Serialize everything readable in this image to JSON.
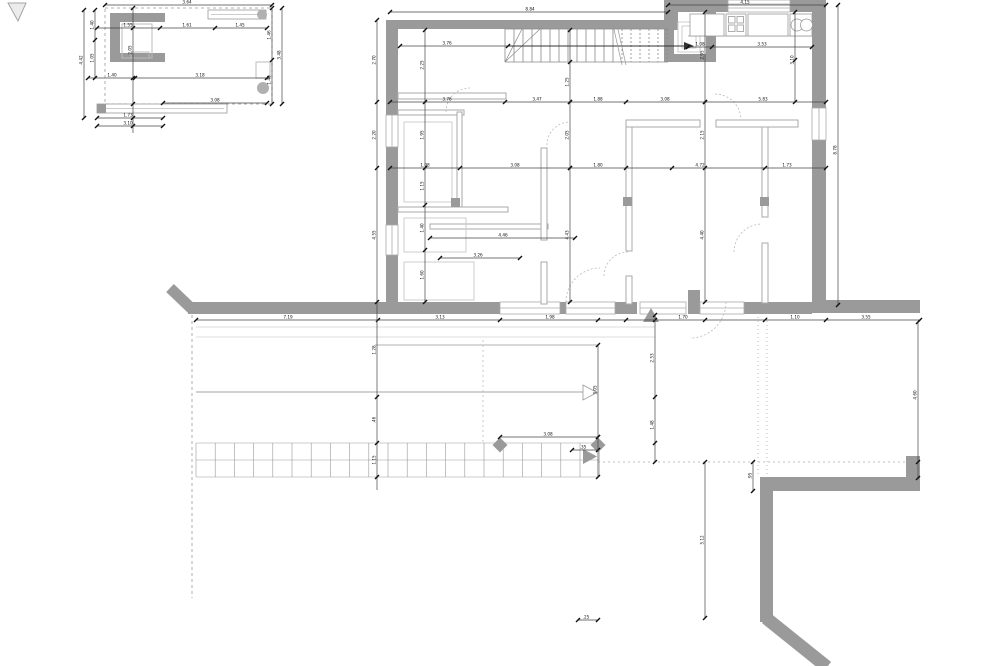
{
  "drawing_type": "architectural-floor-plan",
  "colors": {
    "wall": "#9a9a9a",
    "partition": "#aaaaaa",
    "fixture": "#c8c8c8",
    "dim_line": "#444444",
    "tick": "#111111",
    "text": "#111111",
    "light_line": "#d0d0d0",
    "dash": "#999999",
    "arrow": "#9a9a9a",
    "stair_line": "#888888",
    "tile_line": "#999999"
  },
  "tile_grid": {
    "x": 196,
    "y": 443,
    "cols": 21,
    "col_w": 19.2,
    "rows": 2,
    "row_h": 17
  },
  "stairs": {
    "x_start": 505,
    "x_end": 668,
    "y_top": 29,
    "y_bottom": 62,
    "step": 9,
    "dash_from": 618
  },
  "main": {
    "dim_chains": [
      {
        "dir": "h",
        "pos": 12,
        "from": 390,
        "to": 668,
        "ticks": [
          390,
          668
        ],
        "labels": [
          {
            "at": 530,
            "t": "8.84"
          }
        ]
      },
      {
        "dir": "h",
        "pos": 5,
        "from": 668,
        "to": 826,
        "ticks": [
          668,
          826
        ],
        "labels": [
          {
            "at": 745,
            "t": "4.15"
          }
        ]
      },
      {
        "dir": "h",
        "pos": 46,
        "from": 400,
        "to": 508,
        "ticks": [
          400,
          508
        ],
        "labels": [
          {
            "at": 447,
            "t": "3.76"
          }
        ]
      },
      {
        "dir": "h",
        "pos": 47,
        "from": 688,
        "to": 812,
        "ticks": [
          688,
          712,
          812
        ],
        "labels": [
          {
            "at": 700,
            "t": "1.08"
          },
          {
            "at": 762,
            "t": "3.53"
          }
        ]
      },
      {
        "dir": "h",
        "pos": 102,
        "from": 390,
        "to": 826,
        "ticks": [
          390,
          505,
          570,
          626,
          705,
          826
        ],
        "labels": [
          {
            "at": 447,
            "t": "3.76"
          },
          {
            "at": 537,
            "t": "3.47"
          },
          {
            "at": 598,
            "t": "1.88"
          },
          {
            "at": 665,
            "t": "3.08"
          },
          {
            "at": 763,
            "t": "5.83"
          }
        ]
      },
      {
        "dir": "h",
        "pos": 168,
        "from": 390,
        "to": 826,
        "ticks": [
          390,
          460,
          570,
          626,
          672,
          765,
          826
        ],
        "labels": [
          {
            "at": 425,
            "t": "1.98"
          },
          {
            "at": 515,
            "t": "3.08"
          },
          {
            "at": 598,
            "t": "1.80"
          },
          {
            "at": 700,
            "t": "4.72"
          },
          {
            "at": 787,
            "t": "1.73"
          }
        ]
      },
      {
        "dir": "h",
        "pos": 238,
        "from": 430,
        "to": 575,
        "ticks": [
          430,
          575
        ],
        "labels": [
          {
            "at": 503,
            "t": "4.46"
          }
        ]
      },
      {
        "dir": "h",
        "pos": 258,
        "from": 440,
        "to": 520,
        "ticks": [
          440,
          520
        ],
        "labels": [
          {
            "at": 478,
            "t": "3.26"
          }
        ]
      },
      {
        "dir": "h",
        "pos": 320,
        "from": 196,
        "to": 920,
        "ticks": [
          196,
          378,
          500,
          598,
          626,
          655,
          705,
          765,
          826,
          920
        ],
        "labels": [
          {
            "at": 288,
            "t": "7.19"
          },
          {
            "at": 440,
            "t": "3.13"
          },
          {
            "at": 550,
            "t": "1.98"
          },
          {
            "at": 683,
            "t": "1.70"
          },
          {
            "at": 795,
            "t": "1.10"
          },
          {
            "at": 866,
            "t": "3.55"
          }
        ]
      },
      {
        "dir": "h",
        "pos": 437,
        "from": 500,
        "to": 598,
        "ticks": [
          500,
          598
        ],
        "labels": [
          {
            "at": 548,
            "t": "3.08"
          }
        ]
      },
      {
        "dir": "h",
        "pos": 450,
        "from": 572,
        "to": 598,
        "ticks": [
          572,
          598
        ],
        "labels": [
          {
            "at": 583,
            "t": ".35"
          }
        ]
      },
      {
        "dir": "h",
        "pos": 620,
        "from": 578,
        "to": 598,
        "ticks": [
          578,
          598
        ],
        "labels": [
          {
            "at": 586,
            "t": ".25"
          }
        ]
      },
      {
        "dir": "v",
        "pos": 377,
        "from": 20,
        "to": 490,
        "ticks": [
          20,
          102,
          168,
          302,
          397,
          443,
          477
        ],
        "labels": [
          {
            "at": 60,
            "t": "2.70"
          },
          {
            "at": 135,
            "t": "2.20"
          },
          {
            "at": 235,
            "t": "4.55"
          },
          {
            "at": 350,
            "t": "1.28"
          },
          {
            "at": 420,
            "t": ".46"
          },
          {
            "at": 460,
            "t": "1.15"
          }
        ]
      },
      {
        "dir": "v",
        "pos": 425,
        "from": 30,
        "to": 302,
        "ticks": [
          30,
          102,
          168,
          205,
          250,
          302
        ],
        "labels": [
          {
            "at": 65,
            "t": "2.25"
          },
          {
            "at": 135,
            "t": "1.95"
          },
          {
            "at": 186,
            "t": "1.15"
          },
          {
            "at": 228,
            "t": "1.40"
          },
          {
            "at": 275,
            "t": "1.60"
          }
        ]
      },
      {
        "dir": "v",
        "pos": 570,
        "from": 30,
        "to": 302,
        "ticks": [
          30,
          62,
          102,
          168,
          302
        ],
        "labels": [
          {
            "at": 82,
            "t": "1.25"
          },
          {
            "at": 135,
            "t": "2.05"
          },
          {
            "at": 235,
            "t": "4.43"
          }
        ]
      },
      {
        "dir": "v",
        "pos": 705,
        "from": 12,
        "to": 302,
        "ticks": [
          12,
          102,
          168,
          302
        ],
        "labels": [
          {
            "at": 55,
            "t": "2.95"
          },
          {
            "at": 135,
            "t": "2.15"
          },
          {
            "at": 235,
            "t": "4.40"
          }
        ]
      },
      {
        "dir": "v",
        "pos": 795,
        "from": 12,
        "to": 102,
        "ticks": [
          12,
          60,
          102
        ],
        "labels": [
          {
            "at": 60,
            "t": "3.10"
          }
        ]
      },
      {
        "dir": "v",
        "pos": 655,
        "from": 315,
        "to": 462,
        "ticks": [
          315,
          397,
          443,
          462
        ],
        "labels": [
          {
            "at": 358,
            "t": "2.53"
          },
          {
            "at": 425,
            "t": "1.48"
          }
        ]
      },
      {
        "dir": "v",
        "pos": 598,
        "from": 345,
        "to": 477,
        "ticks": [
          345,
          437,
          477
        ],
        "labels": [
          {
            "at": 390,
            "t": "3.05"
          }
        ]
      },
      {
        "dir": "v",
        "pos": 705,
        "from": 462,
        "to": 618,
        "ticks": [
          462,
          618
        ],
        "labels": [
          {
            "at": 540,
            "t": "5.12"
          }
        ]
      },
      {
        "dir": "v",
        "pos": 838,
        "from": 5,
        "to": 305,
        "ticks": [
          5,
          305
        ],
        "labels": [
          {
            "at": 150,
            "t": "8.78"
          }
        ]
      },
      {
        "dir": "v",
        "pos": 918,
        "from": 322,
        "to": 478,
        "ticks": [
          322,
          462,
          478
        ],
        "labels": [
          {
            "at": 395,
            "t": "4.60"
          }
        ]
      },
      {
        "dir": "v",
        "pos": 753,
        "from": 462,
        "to": 491,
        "ticks": [
          462,
          491
        ],
        "labels": [
          {
            "at": 476,
            "t": ".95"
          }
        ]
      }
    ]
  },
  "inset": {
    "dim_chains": [
      {
        "dir": "h",
        "pos": 5,
        "from": 105,
        "to": 272,
        "ticks": [
          105,
          272
        ],
        "labels": [
          {
            "at": 187,
            "t": "3.64"
          }
        ]
      },
      {
        "dir": "h",
        "pos": 28,
        "from": 97,
        "to": 267,
        "ticks": [
          97,
          160,
          215,
          267
        ],
        "labels": [
          {
            "at": 128,
            "t": "1.55"
          },
          {
            "at": 187,
            "t": "1.61"
          },
          {
            "at": 240,
            "t": "1.45"
          }
        ]
      },
      {
        "dir": "h",
        "pos": 78,
        "from": 88,
        "to": 267,
        "ticks": [
          88,
          135,
          267
        ],
        "labels": [
          {
            "at": 112,
            "t": "1.40"
          },
          {
            "at": 200,
            "t": "3.18"
          }
        ]
      },
      {
        "dir": "h",
        "pos": 103,
        "from": 163,
        "to": 267,
        "ticks": [
          163,
          267
        ],
        "labels": [
          {
            "at": 215,
            "t": "3.08"
          }
        ]
      },
      {
        "dir": "h",
        "pos": 118,
        "from": 97,
        "to": 163,
        "ticks": [
          97,
          163
        ],
        "labels": [
          {
            "at": 128,
            "t": "1.73"
          }
        ]
      },
      {
        "dir": "h",
        "pos": 126,
        "from": 97,
        "to": 163,
        "ticks": [
          97,
          163
        ],
        "labels": [
          {
            "at": 128,
            "t": "3.10"
          }
        ]
      },
      {
        "dir": "v",
        "pos": 84,
        "from": 10,
        "to": 118,
        "ticks": [
          10,
          118
        ],
        "labels": [
          {
            "at": 60,
            "t": "4.42"
          }
        ]
      },
      {
        "dir": "v",
        "pos": 95,
        "from": 10,
        "to": 78,
        "ticks": [
          10,
          40,
          78
        ],
        "labels": [
          {
            "at": 25,
            "t": "1.40"
          },
          {
            "at": 58,
            "t": "1.05"
          }
        ]
      },
      {
        "dir": "v",
        "pos": 272,
        "from": 8,
        "to": 104,
        "ticks": [
          8,
          60,
          104
        ],
        "labels": [
          {
            "at": 35,
            "t": "1.46"
          },
          {
            "at": 80,
            "t": "1.40"
          }
        ]
      },
      {
        "dir": "v",
        "pos": 282,
        "from": 8,
        "to": 104,
        "ticks": [
          8,
          104
        ],
        "labels": [
          {
            "at": 55,
            "t": "3.48"
          }
        ]
      },
      {
        "dir": "v",
        "pos": 133,
        "from": 8,
        "to": 133,
        "ticks": [
          8,
          28,
          78,
          104,
          118,
          126
        ],
        "labels": [
          {
            "at": 50,
            "t": "2.05"
          }
        ]
      }
    ]
  }
}
